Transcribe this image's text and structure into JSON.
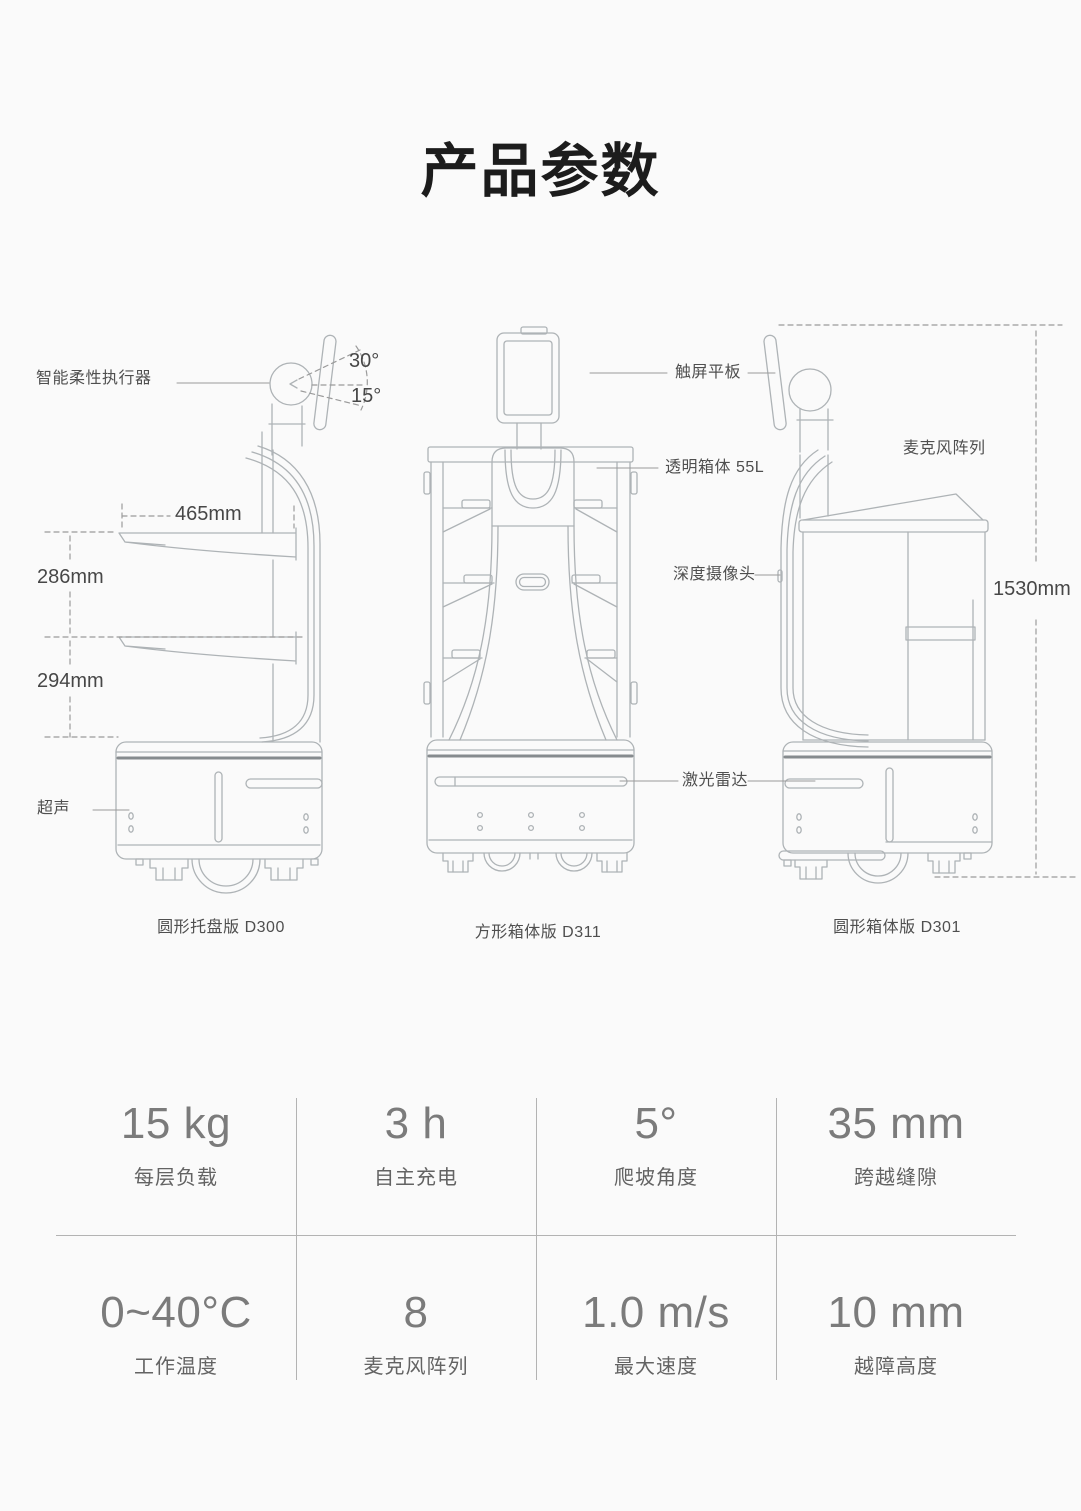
{
  "page": {
    "title": "产品参数"
  },
  "diagram": {
    "callouts": {
      "actuator": "智能柔性执行器",
      "angle_up": "30°",
      "angle_down": "15°",
      "tray_width": "465mm",
      "tray_spacing_upper": "286mm",
      "tray_spacing_lower": "294mm",
      "ultrasonic": "超声",
      "touchscreen": "触屏平板",
      "transparent_box": "透明箱体 55L",
      "depth_camera": "深度摄像头",
      "lidar": "激光雷达",
      "mic_array": "麦克风阵列",
      "overall_height": "1530mm"
    },
    "robots": [
      {
        "caption": "圆形托盘版 D300"
      },
      {
        "caption": "方形箱体版 D311"
      },
      {
        "caption": "圆形箱体版 D301"
      }
    ]
  },
  "specs": {
    "items": [
      {
        "value": "15 kg",
        "label": "每层负载"
      },
      {
        "value": "3 h",
        "label": "自主充电"
      },
      {
        "value": "5°",
        "label": "爬坡角度"
      },
      {
        "value": "35 mm",
        "label": "跨越缝隙"
      },
      {
        "value": "0~40°C",
        "label": "工作温度"
      },
      {
        "value": "8",
        "label": "麦克风阵列"
      },
      {
        "value": "1.0 m/s",
        "label": "最大速度"
      },
      {
        "value": "10 mm",
        "label": "越障高度"
      }
    ]
  },
  "colors": {
    "background": "#fafafa",
    "title_text": "#1c1c1c",
    "diagram_text": "#4f4f4f",
    "drawing_line": "#aeb3b6",
    "drawing_accent_line": "#868b8e",
    "spec_value_text": "#7b7b7b",
    "spec_label_text": "#636363",
    "grid_divider": "#b3b3b3"
  }
}
